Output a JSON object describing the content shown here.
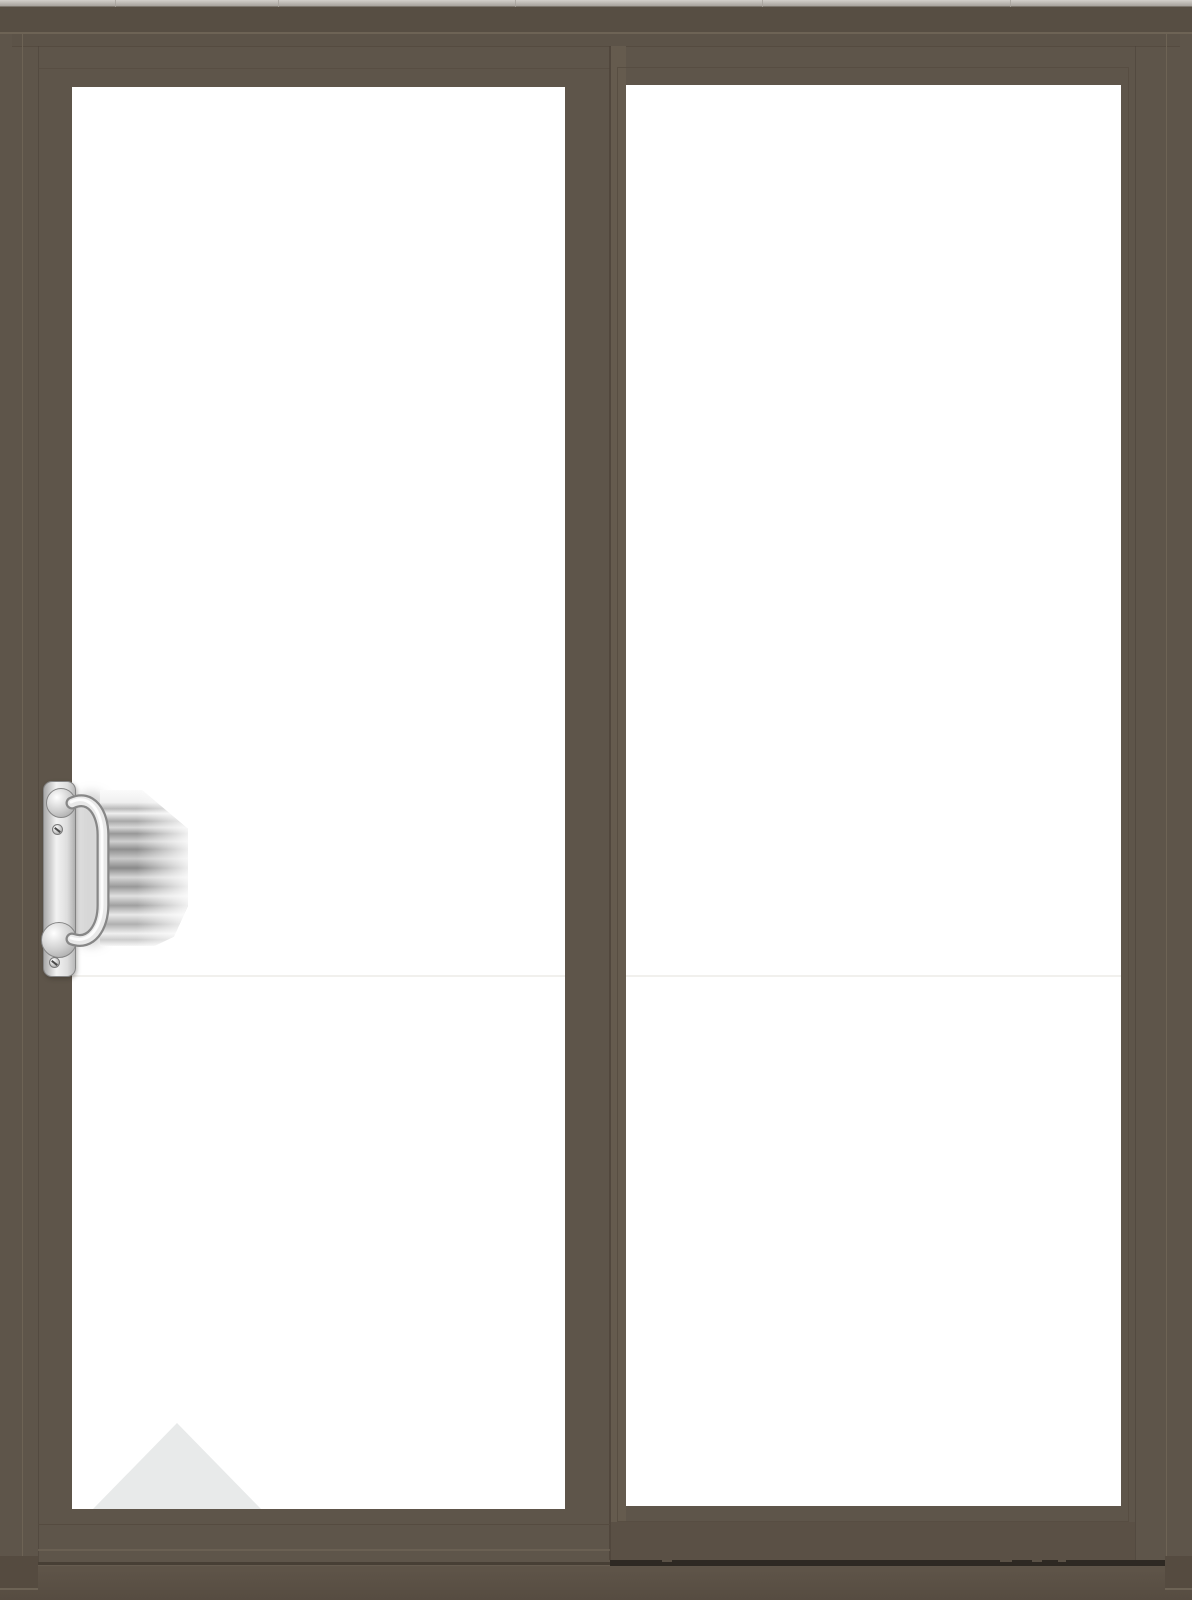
{
  "scene": {
    "product": "two-panel-sliding-glass-patio-door",
    "view": "front-exterior",
    "panels": [
      {
        "id": "left",
        "type": "sliding-panel",
        "glazing": "clear-glass",
        "hardware": "vertical-pull-handle"
      },
      {
        "id": "right",
        "type": "fixed-panel",
        "glazing": "clear-glass",
        "hardware": "none"
      }
    ],
    "handle": {
      "finish": "satin-chrome",
      "parts": [
        "escutcheon-plate",
        "top-screw",
        "bottom-screw",
        "d-shaped-pull"
      ],
      "reflection": "gray-banded-reflection-on-glass"
    },
    "reflections": [
      "triangular-light-reflection-bottom-left-glass",
      "faint-horizontal-glass-line"
    ]
  },
  "colors": {
    "frame_base": "#5e554a",
    "frame_dark": "#554b40",
    "frame_darker": "#4b4238",
    "frame_light": "#6d6355",
    "head_top": "#574e43",
    "head_inner": "#5c5348",
    "stile_light": "#655b4e",
    "rail_dark": "#5a5045",
    "track_dark": "#2e2923",
    "track_soft": "#473f35",
    "sill_top": "#5f5549",
    "sill_bottom": "#564c41",
    "strip_light": "#d3d0cb",
    "strip_dark": "#a7a29c",
    "glass": "#ffffff",
    "glass_line": "#f1f0ed",
    "reflection": "#e8eaea",
    "chrome_light": "#f2f2f2",
    "chrome_mid": "#cccccc",
    "chrome_dark": "#9a9a9a",
    "chrome_edge": "#858585"
  }
}
